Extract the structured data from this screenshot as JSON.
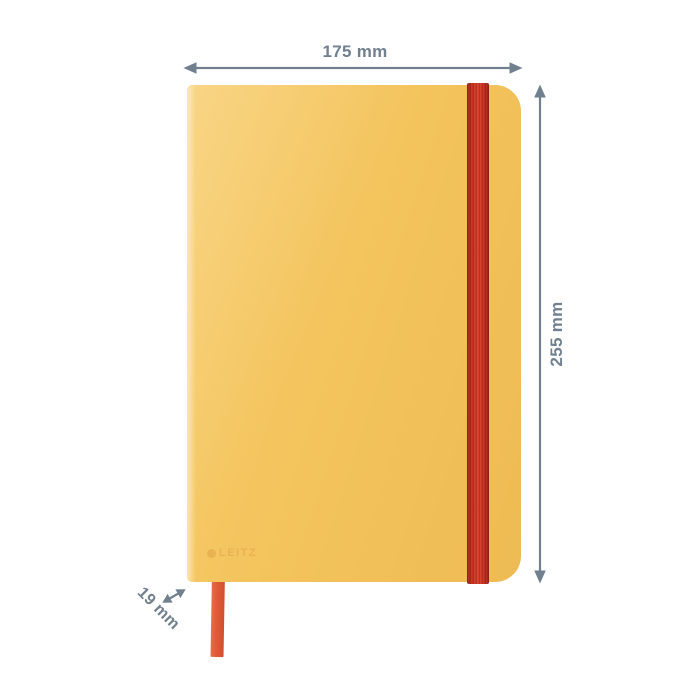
{
  "product": {
    "type": "notebook",
    "brand_logo_text": "LEITZ",
    "colors": {
      "cover": "#F4C45D",
      "cover_light": "#F8D078",
      "cover_dark": "#EEBB53",
      "band": "#C93320",
      "ribbon": "#E05B38",
      "dimension": "#71808F",
      "logo": "#E1A44B",
      "background": "#FFFFFF"
    }
  },
  "dimensions": {
    "width_label": "175 mm",
    "height_label": "255 mm",
    "depth_label": "19 mm"
  }
}
